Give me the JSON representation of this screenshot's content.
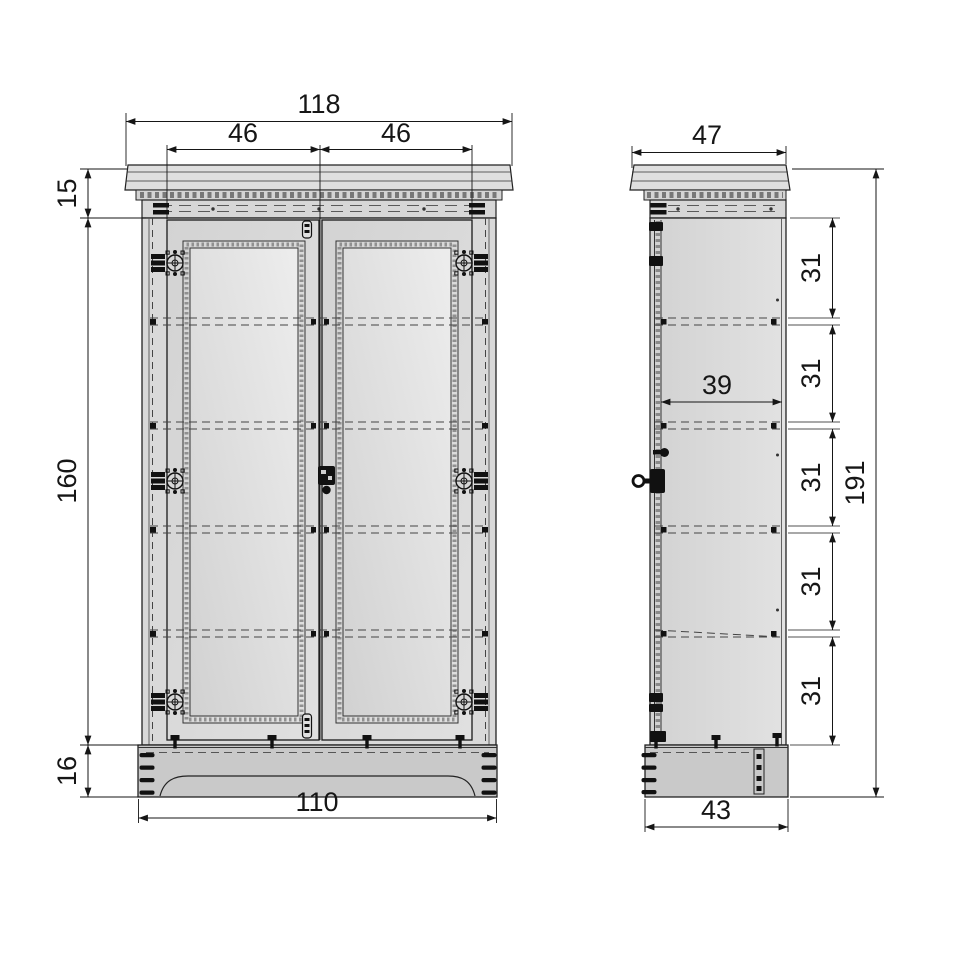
{
  "drawing": {
    "front": {
      "overall_width": "118",
      "door_width_left": "46",
      "door_width_right": "46",
      "cornice_height": "15",
      "carcass_height": "160",
      "plinth_height": "16",
      "base_width": "110"
    },
    "side": {
      "top_depth": "47",
      "interior_depth": "39",
      "shelf_spacings": [
        "31",
        "31",
        "31",
        "31",
        "31"
      ],
      "overall_height": "191",
      "base_depth": "43"
    },
    "colors": {
      "line": "#222222",
      "hidden_line": "#444444",
      "fill_body": "#d9d9d9",
      "fill_cornice": "#dfdfdf",
      "fill_base": "#c9c9c9",
      "background": "#ffffff"
    }
  }
}
